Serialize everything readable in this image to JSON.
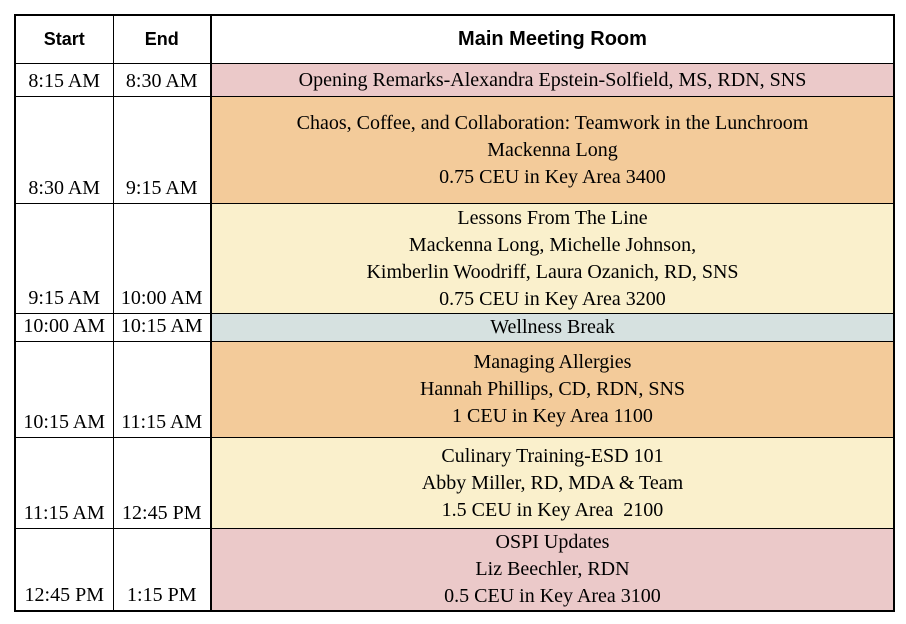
{
  "table": {
    "headers": {
      "start": "Start",
      "end": "End",
      "room": "Main Meeting Room"
    },
    "colors": {
      "pink": "#ebc9c9",
      "orange": "#f3cb9a",
      "yellow": "#faf0cc",
      "blue": "#d6e1e0"
    },
    "rows": [
      {
        "start": "8:15 AM",
        "end": "8:30 AM",
        "color_key": "pink",
        "height": 33,
        "lines": [
          "Opening Remarks-Alexandra Epstein-Solfield, MS, RDN, SNS"
        ]
      },
      {
        "start": "8:30 AM",
        "end": "9:15 AM",
        "color_key": "orange",
        "height": 107,
        "lines": [
          "Chaos, Coffee, and Collaboration: Teamwork in the Lunchroom",
          "Mackenna Long",
          "0.75 CEU in Key Area 3400"
        ]
      },
      {
        "start": "9:15 AM",
        "end": "10:00 AM",
        "color_key": "yellow",
        "height": 110,
        "lines": [
          "Lessons From The Line",
          "Mackenna Long, Michelle Johnson,",
          "Kimberlin Woodriff, Laura Ozanich, RD, SNS",
          "0.75 CEU in Key Area 3200"
        ]
      },
      {
        "start": "10:00 AM",
        "end": "10:15 AM",
        "color_key": "blue",
        "height": 28,
        "lines": [
          "Wellness Break"
        ]
      },
      {
        "start": "10:15 AM",
        "end": "11:15 AM",
        "color_key": "orange",
        "height": 96,
        "lines": [
          "Managing Allergies",
          "Hannah Phillips, CD, RDN, SNS",
          "1 CEU in Key Area 1100"
        ]
      },
      {
        "start": "11:15 AM",
        "end": "12:45 PM",
        "color_key": "yellow",
        "height": 91,
        "lines": [
          "Culinary Training-ESD 101",
          "Abby Miller, RD, MDA & Team",
          "1.5 CEU in Key Area  2100"
        ]
      },
      {
        "start": "12:45 PM",
        "end": "1:15 PM",
        "color_key": "pink",
        "height": 82,
        "lines": [
          "OSPI Updates",
          "Liz Beechler, RDN",
          "0.5 CEU in Key Area 3100"
        ]
      }
    ]
  }
}
